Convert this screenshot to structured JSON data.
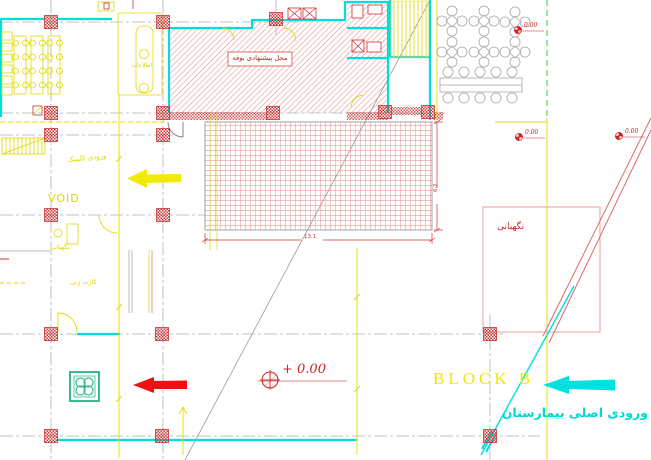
{
  "drawing": {
    "labels": {
      "buffet": "محل پیشنهادی بوفه",
      "information": "اطلاعات",
      "clinic_entrance": "ورودی کلینیک",
      "void": "VOID",
      "guard_post": "نگهبانی",
      "card_punch": "کارت زنی",
      "guard_room": "نگهبانی",
      "block": "BLOCK B",
      "main_entrance": "ورودی اصلی بیمارستان"
    },
    "dimensions": {
      "terrace_width": "13.1",
      "terrace_depth": "6.2"
    },
    "elevations": {
      "main": "+ 0.00",
      "spot": "0.00"
    },
    "colors": {
      "wall_cyan": "#00dede",
      "annotation_yellow": "#e9e000",
      "hatch_red": "#cc3333",
      "arrow_red": "#ee1111",
      "arrow_cyan": "#00e0e0",
      "site_green": "#33cc33"
    }
  }
}
